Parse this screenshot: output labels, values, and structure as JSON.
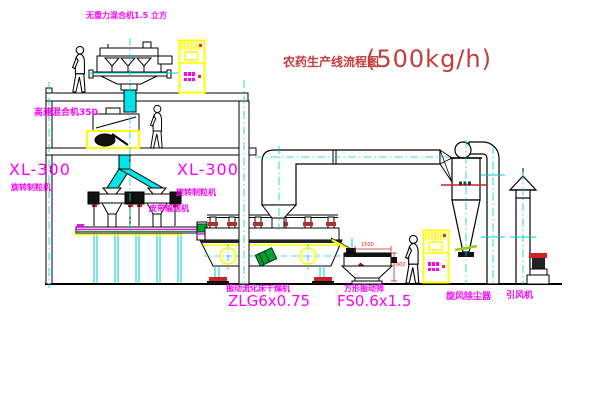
{
  "title": {
    "text": "农药生产线流程图",
    "capacity": "(500kg/h)"
  },
  "labels": {
    "gravity_mixer": "无重力混合机1.5 立方",
    "high_speed_mixer": "高速混合机350",
    "granulator_model_left": "XL-300",
    "granulator_left": "旋转制粒机",
    "granulator_model_right": "XL-300",
    "granulator_right": "旋转制粒机",
    "belt_conveyor": "皮带输送机",
    "fluid_bed_dryer": "振动流化床干燥机",
    "dryer_model": "ZLG6x0.75",
    "vibrating_screen": "方形振动筛",
    "screen_model": "FS0.6x1.5",
    "cyclone": "旋风除尘器",
    "induced_draft_fan": "引风机"
  },
  "dimensions": {
    "screen_length": "1500",
    "screen_height": "600"
  },
  "palette": {
    "label_magenta": "#ff00ff",
    "title_red": "#c43c3c",
    "detail_red": "#cc2222",
    "cabinet_yellow": "#ffff00",
    "centerline_cyan": "#00cccc",
    "chute_cyan": "#00e5e5",
    "motor_green": "#00a033",
    "line_black": "#000000"
  }
}
